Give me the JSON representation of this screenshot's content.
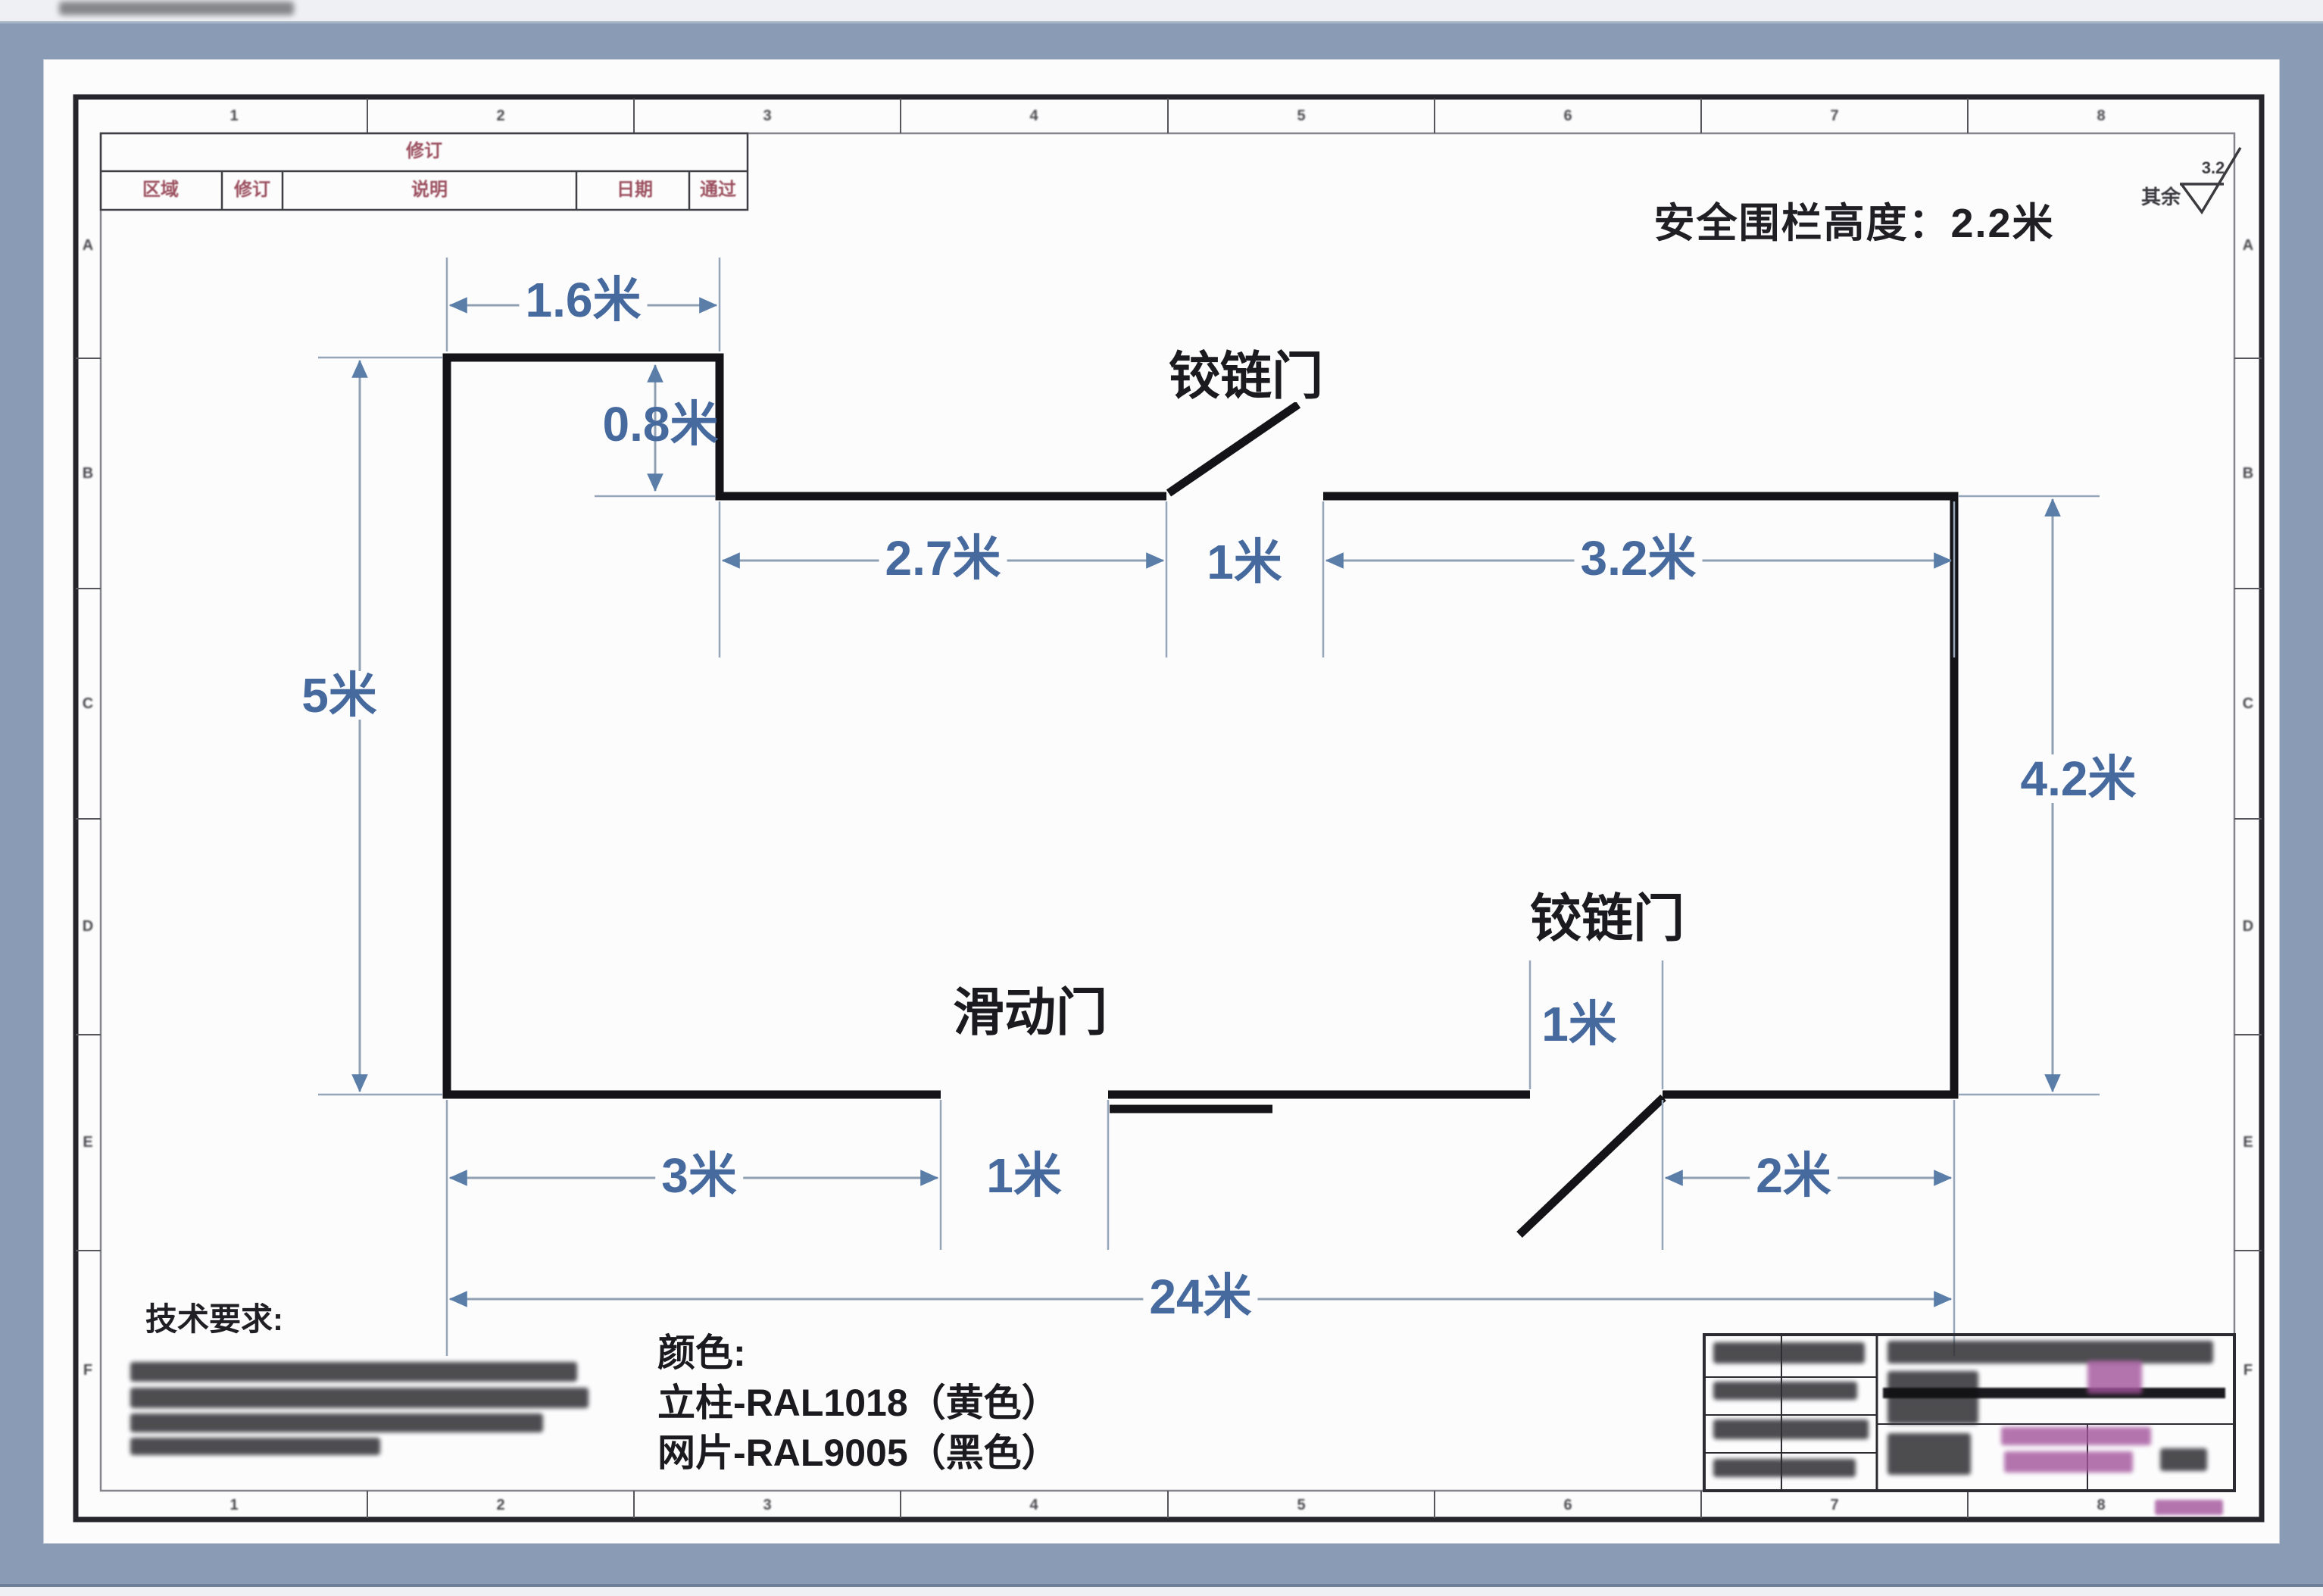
{
  "header_note": "安全围栏高度：2.2米",
  "roughness": {
    "prefix": "其余",
    "value": "3.2"
  },
  "revision_table": {
    "title": "修订",
    "columns": [
      "区域",
      "修订",
      "说明",
      "日期",
      "通过"
    ]
  },
  "labels": {
    "hinge_gate_top": "铰链门",
    "hinge_gate_bottom": "铰链门",
    "sliding_gate": "滑动门",
    "tech_req": "技术要求:"
  },
  "color_note": {
    "heading": "颜色:",
    "post_line": "立柱-RAL1018（黄色）",
    "mesh_line": "网片-RAL9005（黑色）"
  },
  "dimensions": {
    "top_offset": "1.6米",
    "step_depth": "0.8米",
    "top_left_span": "2.7米",
    "top_gate_width": "1米",
    "top_right_span": "3.2米",
    "left_height": "5米",
    "right_height": "4.2米",
    "bottom_left_span": "3米",
    "sliding_gate_width": "1米",
    "bottom_gate_width": "1米",
    "bottom_right_span": "2米",
    "total_width": "24米"
  },
  "zones": {
    "cols": [
      "1",
      "2",
      "3",
      "4",
      "5",
      "6",
      "7",
      "8"
    ],
    "rows": [
      "A",
      "B",
      "C",
      "D",
      "E",
      "F"
    ]
  },
  "colors": {
    "fence": "#141418",
    "dimension_text": "#46699e",
    "dimension_line": "#8fa0b4",
    "arrow": "#5b7ea9",
    "table_text": "#9b4f5e",
    "window_band": "#8a9cb5"
  }
}
